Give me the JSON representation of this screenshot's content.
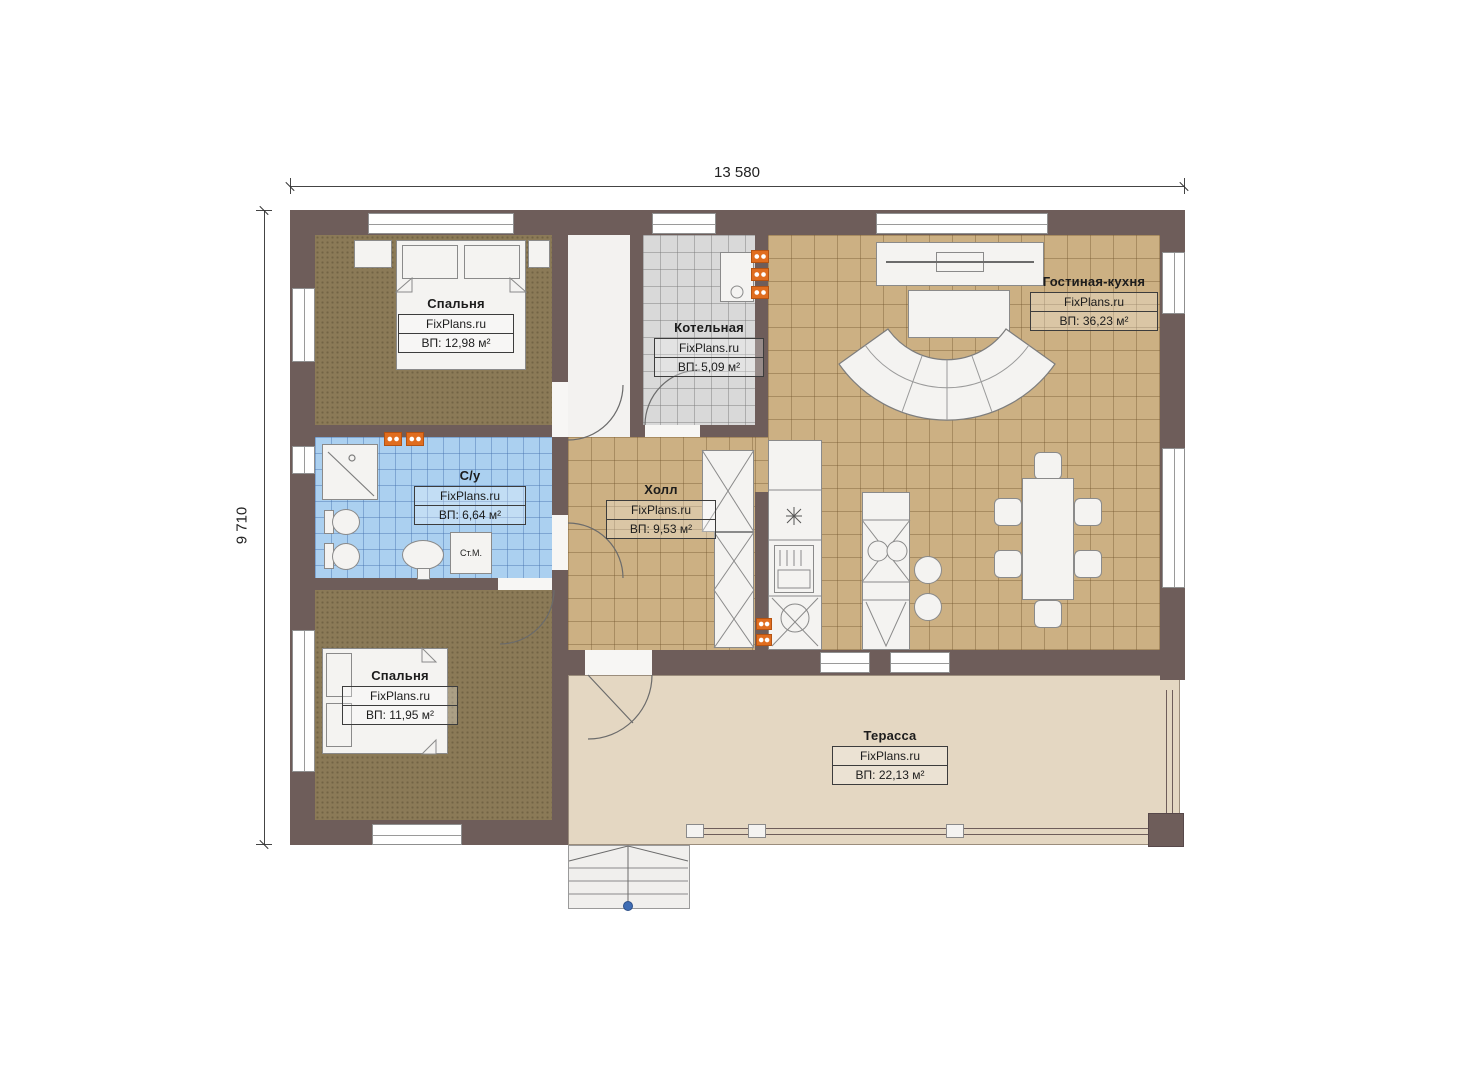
{
  "dimensions": {
    "width": "13 580",
    "height": "9 710"
  },
  "rooms": {
    "bedroom1": {
      "name": "Спальня",
      "brand": "FixPlans.ru",
      "area": "ВП: 12,98 м²"
    },
    "boiler": {
      "name": "Котельная",
      "brand": "FixPlans.ru",
      "area": "ВП: 5,09 м²"
    },
    "living": {
      "name": "Гостиная-кухня",
      "brand": "FixPlans.ru",
      "area": "ВП: 36,23 м²"
    },
    "bathroom": {
      "name": "С/у",
      "brand": "FixPlans.ru",
      "area": "ВП: 6,64 м²"
    },
    "hall": {
      "name": "Холл",
      "brand": "FixPlans.ru",
      "area": "ВП: 9,53 м²"
    },
    "bedroom2": {
      "name": "Спальня",
      "brand": "FixPlans.ru",
      "area": "ВП: 11,95 м²"
    },
    "terrace": {
      "name": "Терасса",
      "brand": "FixPlans.ru",
      "area": "ВП: 22,13 м²"
    }
  },
  "fixtures": {
    "washing_machine": "Ст.М."
  },
  "colors": {
    "wall": "#6e5d5a",
    "tile_tan": "#ccb083",
    "tile_blue": "#abd0f0",
    "tile_gray": "#d9d9d9",
    "carpet": "#8b7a57",
    "terrace": "#e4d7c2",
    "radiator": "#e06d1f",
    "stair_marker": "#3f6db4"
  }
}
